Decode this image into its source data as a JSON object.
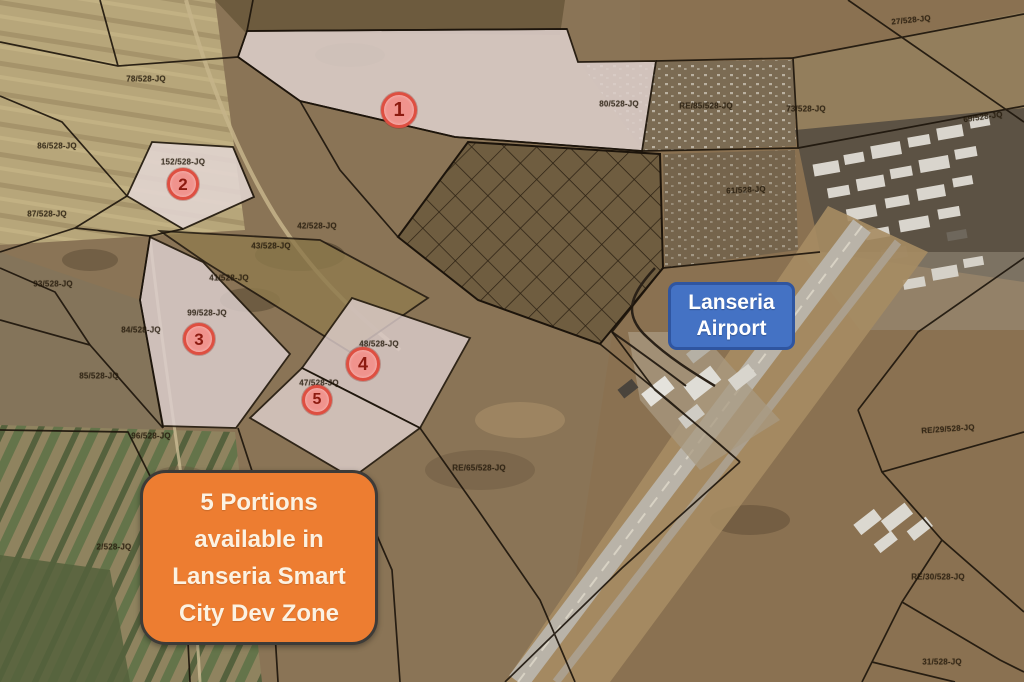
{
  "title": "Lanseria Smart City Dev Zone — aerial cadastral map",
  "airport_label": {
    "line1": "Lanseria",
    "line2": "Airport"
  },
  "callout": {
    "lines": [
      "5 Portions",
      "available in",
      "Lanseria Smart",
      "City Dev Zone"
    ]
  },
  "markers": [
    {
      "number": "1",
      "x": 399,
      "y": 110,
      "r": 15
    },
    {
      "number": "2",
      "x": 183,
      "y": 184,
      "r": 13
    },
    {
      "number": "3",
      "x": 199,
      "y": 339,
      "r": 13
    },
    {
      "number": "4",
      "x": 363,
      "y": 364,
      "r": 14
    },
    {
      "number": "5",
      "x": 317,
      "y": 400,
      "r": 12
    }
  ],
  "parcel_labels": [
    {
      "text": "78/528-JQ",
      "x": 146,
      "y": 79
    },
    {
      "text": "27/528-JQ",
      "x": 911,
      "y": 20,
      "rot": -6
    },
    {
      "text": "86/528-JQ",
      "x": 57,
      "y": 146
    },
    {
      "text": "152/528-JQ",
      "x": 183,
      "y": 162
    },
    {
      "text": "87/528-JQ",
      "x": 47,
      "y": 214
    },
    {
      "text": "80/528-JQ",
      "x": 619,
      "y": 104
    },
    {
      "text": "RE/85/528-JQ",
      "x": 706,
      "y": 106
    },
    {
      "text": "73/528-JQ",
      "x": 806,
      "y": 109
    },
    {
      "text": "69/528-JQ",
      "x": 983,
      "y": 117,
      "rot": -8
    },
    {
      "text": "61/528-JQ",
      "x": 746,
      "y": 190,
      "rot": -3
    },
    {
      "text": "42/528-JQ",
      "x": 317,
      "y": 226
    },
    {
      "text": "43/528-JQ",
      "x": 271,
      "y": 246
    },
    {
      "text": "41/528-JQ",
      "x": 229,
      "y": 278
    },
    {
      "text": "99/528-JQ",
      "x": 207,
      "y": 313
    },
    {
      "text": "48/528-JQ",
      "x": 379,
      "y": 344
    },
    {
      "text": "47/528-JQ",
      "x": 319,
      "y": 383
    },
    {
      "text": "93/528-JQ",
      "x": 53,
      "y": 284
    },
    {
      "text": "84/528-JQ",
      "x": 141,
      "y": 330
    },
    {
      "text": "85/528-JQ",
      "x": 99,
      "y": 376
    },
    {
      "text": "96/528-JQ",
      "x": 151,
      "y": 436
    },
    {
      "text": "2/528-JQ",
      "x": 114,
      "y": 547
    },
    {
      "text": "RE/65/528-JQ",
      "x": 479,
      "y": 468
    },
    {
      "text": "RE/29/528-JQ",
      "x": 948,
      "y": 429,
      "rot": -4
    },
    {
      "text": "RE/30/528-JQ",
      "x": 938,
      "y": 577
    },
    {
      "text": "31/528-JQ",
      "x": 942,
      "y": 662
    }
  ],
  "colors": {
    "airport_box_bg": "#4472c4",
    "airport_box_border": "#2f55a0",
    "airport_box_text": "#ffffff",
    "callout_bg": "#ed7d31",
    "callout_border": "#3d3b38",
    "callout_text": "#fcf2e2",
    "marker_fill": "#f0938d",
    "marker_ring": "#de4f41",
    "marker_text": "#8c1a10",
    "boundary_line": "#1c140b",
    "highlight_parcel": "#ddcfca"
  }
}
